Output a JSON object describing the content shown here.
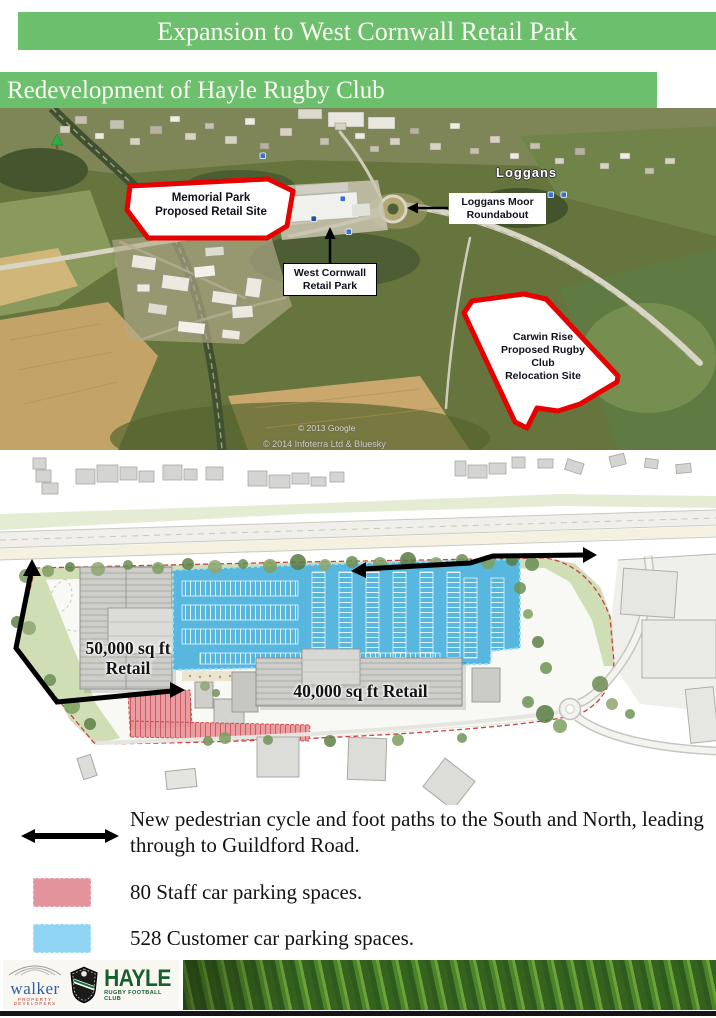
{
  "banners": {
    "title": "Expansion to West Cornwall Retail Park",
    "subtitle": "Redevelopment of Hayle Rugby Club"
  },
  "aerial_map": {
    "memorial_park_label": "Memorial Park\nProposed Retail Site",
    "loggans_moor_label": "Loggans Moor\nRoundabout",
    "west_cornwall_label": "West Cornwall\nRetail Park",
    "carwin_rise_label": "Carwin Rise\nProposed Rugby\nClub\nRelocation Site",
    "place_name": "Loggans",
    "copyright_line1": "© 2013 Google",
    "copyright_line2": "© 2014 Infoterra Ltd & Bluesky",
    "site_outline_color": "#e60000"
  },
  "site_plan": {
    "retail_50k_label": "50,000 sq ft\nRetail",
    "retail_40k_label": "40,000 sq ft Retail",
    "customer_parking_color": "#57b7de",
    "staff_parking_color": "#e9969b",
    "path_color": "#000000"
  },
  "legend": {
    "items": [
      {
        "symbol": "path-arrow",
        "text": "New pedestrian cycle and foot paths to the South and North, leading through to Guildford Road."
      },
      {
        "symbol": "staff-parking-swatch",
        "color": "#e2939b",
        "text": "80 Staff car parking spaces."
      },
      {
        "symbol": "customer-parking-swatch",
        "color": "#8fd4f2",
        "text": "528 Customer car parking spaces."
      }
    ]
  },
  "footer": {
    "walker_name": "walker",
    "walker_tagline": "PROPERTY DEVELOPERS",
    "hayle_name": "HAYLE",
    "hayle_tagline": "RUGBY FOOTBALL CLUB"
  },
  "colors": {
    "banner_green": "#6cbf6d",
    "walker_blue": "#2b5ea7",
    "hayle_green": "#175f2c"
  }
}
